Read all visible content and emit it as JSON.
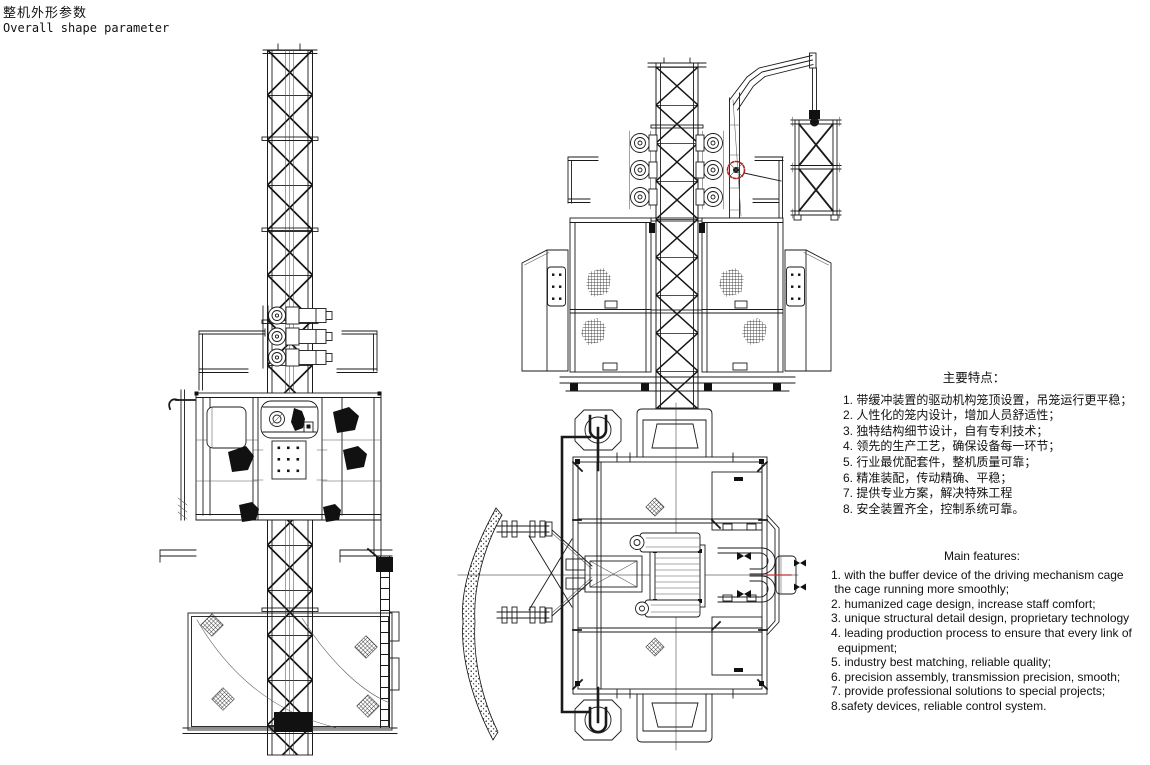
{
  "page": {
    "background": "#ffffff",
    "drawing_line_color": "#1a1a1a",
    "accent_red": "#c03030"
  },
  "header": {
    "title_zh": "整机外形参数",
    "title_en": "Overall shape parameter"
  },
  "features_zh": {
    "heading": "主要特点：",
    "items": [
      "1. 带缓冲装置的驱动机构笼顶设置，吊笼运行更平稳；",
      "2. 人性化的笼内设计，增加人员舒适性；",
      "3. 独特结构细节设计，自有专利技术；",
      "4. 领先的生产工艺，确保设备每一环节；",
      "5. 行业最优配套件，整机质量可靠；",
      "6. 精准装配，传动精确、平稳；",
      "7. 提供专业方案，解决特殊工程",
      "8. 安全装置齐全，控制系统可靠。"
    ]
  },
  "features_en": {
    "heading": "Main features:",
    "lines": [
      "1. with the buffer device of the driving mechanism cage",
      " the cage running more smoothly;",
      "2. humanized cage design, increase staff comfort;",
      "3. unique structural detail design, proprietary technology",
      "4. leading production process to ensure that every link of",
      "  equipment;",
      "5. industry best matching, reliable quality;",
      "6. precision assembly, transmission precision, smooth;",
      "7. provide professional solutions to special projects;",
      "8.safety devices, reliable control system."
    ]
  },
  "drawings": {
    "views": [
      {
        "name": "single-cage-side-elevation"
      },
      {
        "name": "twin-cage-front-elevation"
      },
      {
        "name": "top-plan-view"
      }
    ]
  }
}
